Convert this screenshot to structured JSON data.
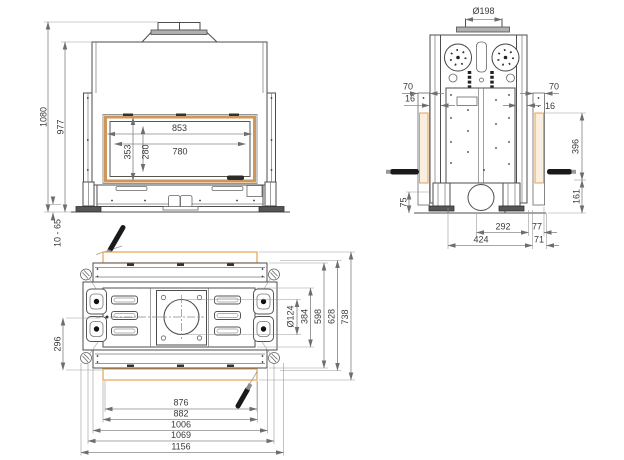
{
  "colors": {
    "accent_orange": "#E8962E",
    "band_orange": "#E8A050",
    "frame_tan": "#CE9659"
  },
  "front_view": {
    "dims": {
      "overall_height": "1080",
      "body_height": "977",
      "foot_adjust_range": "10 - 65",
      "opening_width_outer": "853",
      "opening_width_inner": "780",
      "opening_height_outer": "353",
      "opening_height_inner": "280"
    }
  },
  "side_view": {
    "dims": {
      "flue_diameter": "Ø198",
      "left_frame_width": "70",
      "left_profile_width": "16",
      "right_frame_width": "70",
      "right_profile_width": "16",
      "lift_height": "396",
      "base_height": "161",
      "foot_height": "75",
      "bottom_inner": "292",
      "bottom_rear": "77",
      "bottom_total": "424",
      "bottom_front": "71"
    }
  },
  "plan_view": {
    "dims": {
      "left_spacing": "296",
      "outlet_diameter": "Ø124",
      "depth_inner": "384",
      "depth_rails": "598",
      "depth_body": "628",
      "depth_overall": "738",
      "width_glass": "876",
      "width_opening": "882",
      "width_rails": "1006",
      "width_body": "1069",
      "width_overall": "1156"
    }
  }
}
